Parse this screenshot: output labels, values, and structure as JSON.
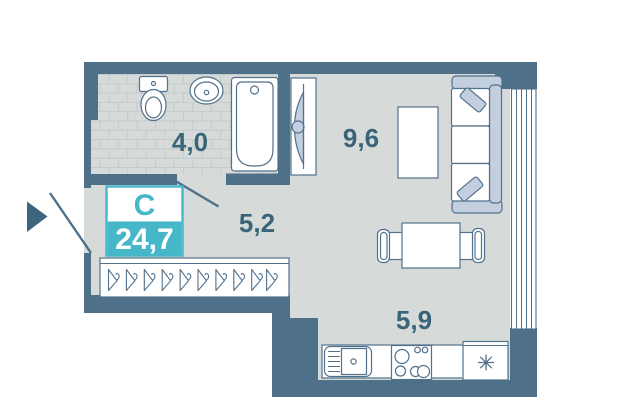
{
  "floorplan": {
    "apartment_type_label": "С",
    "total_area": "24,7",
    "rooms": [
      {
        "id": "bathroom",
        "area": "4,0"
      },
      {
        "id": "hallway",
        "area": "5,2"
      },
      {
        "id": "living-room",
        "area": "9,6"
      },
      {
        "id": "kitchen",
        "area": "5,9"
      }
    ],
    "colors": {
      "wall": "#4e7089",
      "floor": "#d6dad9",
      "tile_line": "#c3cbcc",
      "accent_teal": "#45b7c9",
      "soft_blue": "#c3cfdf",
      "label_text": "#3a6478",
      "fixture_fill": "#ffffff",
      "background": "#ffffff"
    },
    "symbols": {
      "entrance": "entrance-arrow",
      "fridge": "snowflake",
      "closet": "hangers",
      "loggia": "window-glazing"
    }
  }
}
